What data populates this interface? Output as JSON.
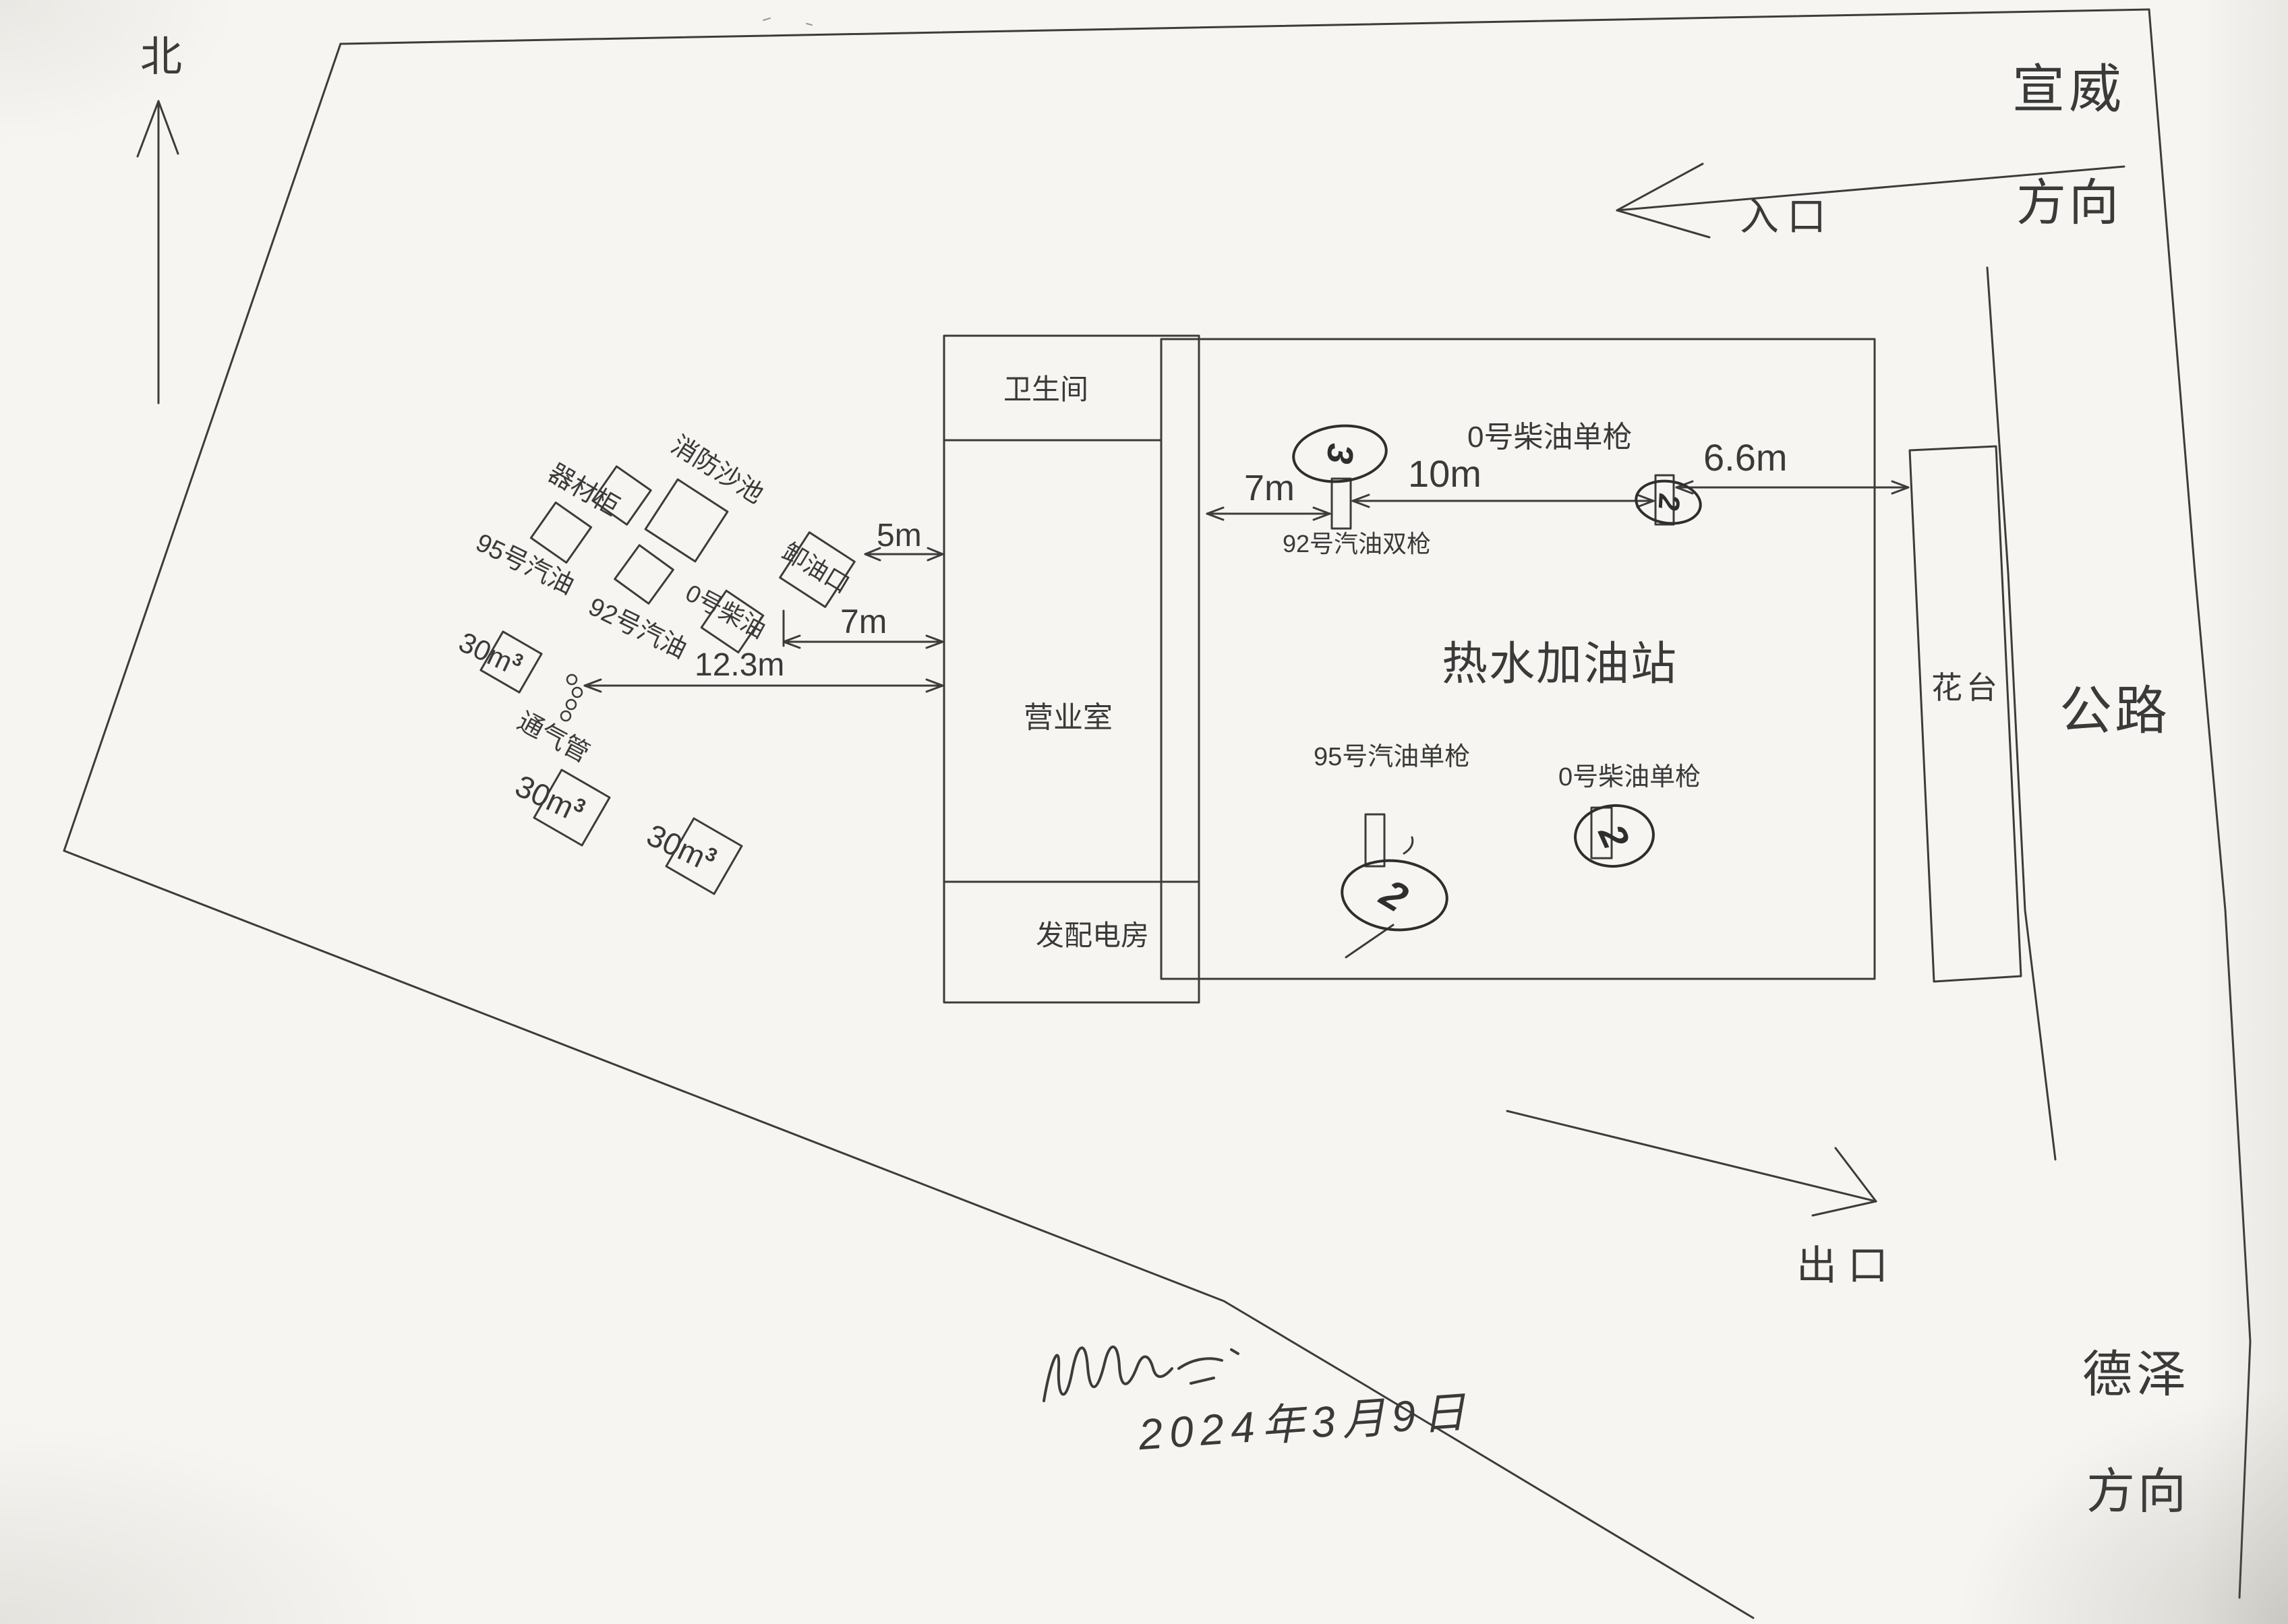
{
  "colors": {
    "ink": "#3a3a3a",
    "paper": "#f6f5f1"
  },
  "compass": {
    "north_label": "北"
  },
  "site": {
    "top_right_direction_line1": "宣威",
    "top_right_direction_line2": "方向",
    "entrance_label": "入口",
    "exit_label": "出口",
    "road_label": "公路",
    "flower_bed_label": "花台",
    "bottom_right_direction_line1": "德泽",
    "bottom_right_direction_line2": "方向"
  },
  "station": {
    "title": "热水加油站",
    "building_rooms": {
      "restroom": "卫生间",
      "office": "营业室",
      "power_room": "发配电房"
    },
    "dispensers": {
      "gas92_double": {
        "label": "92号汽油双枪",
        "mark": "3"
      },
      "diesel0_top": {
        "label": "0号柴油单枪",
        "mark": "2"
      },
      "gas95_single": {
        "label": "95号汽油单枪",
        "mark": "2"
      },
      "diesel0_bottom": {
        "label": "0号柴油单枪",
        "mark": "2"
      }
    }
  },
  "tank_farm": {
    "equipment_cabinet": "器材柜",
    "fire_sand_pool": "消防沙池",
    "tank_95": "95号汽油",
    "tank_92": "92号汽油",
    "tank_diesel": "0号柴油",
    "unloading_port": "卸油口",
    "vent_pipe": "通气管",
    "tank_volume": "30m",
    "tank_volume_sup": "3"
  },
  "dimensions": {
    "d5m": "5m",
    "d7m_left": "7m",
    "d12_3m": "12.3m",
    "d7m_canopy": "7m",
    "d10m": "10m",
    "d6_6m": "6.6m"
  },
  "footer": {
    "date": "2024年3月9日"
  }
}
